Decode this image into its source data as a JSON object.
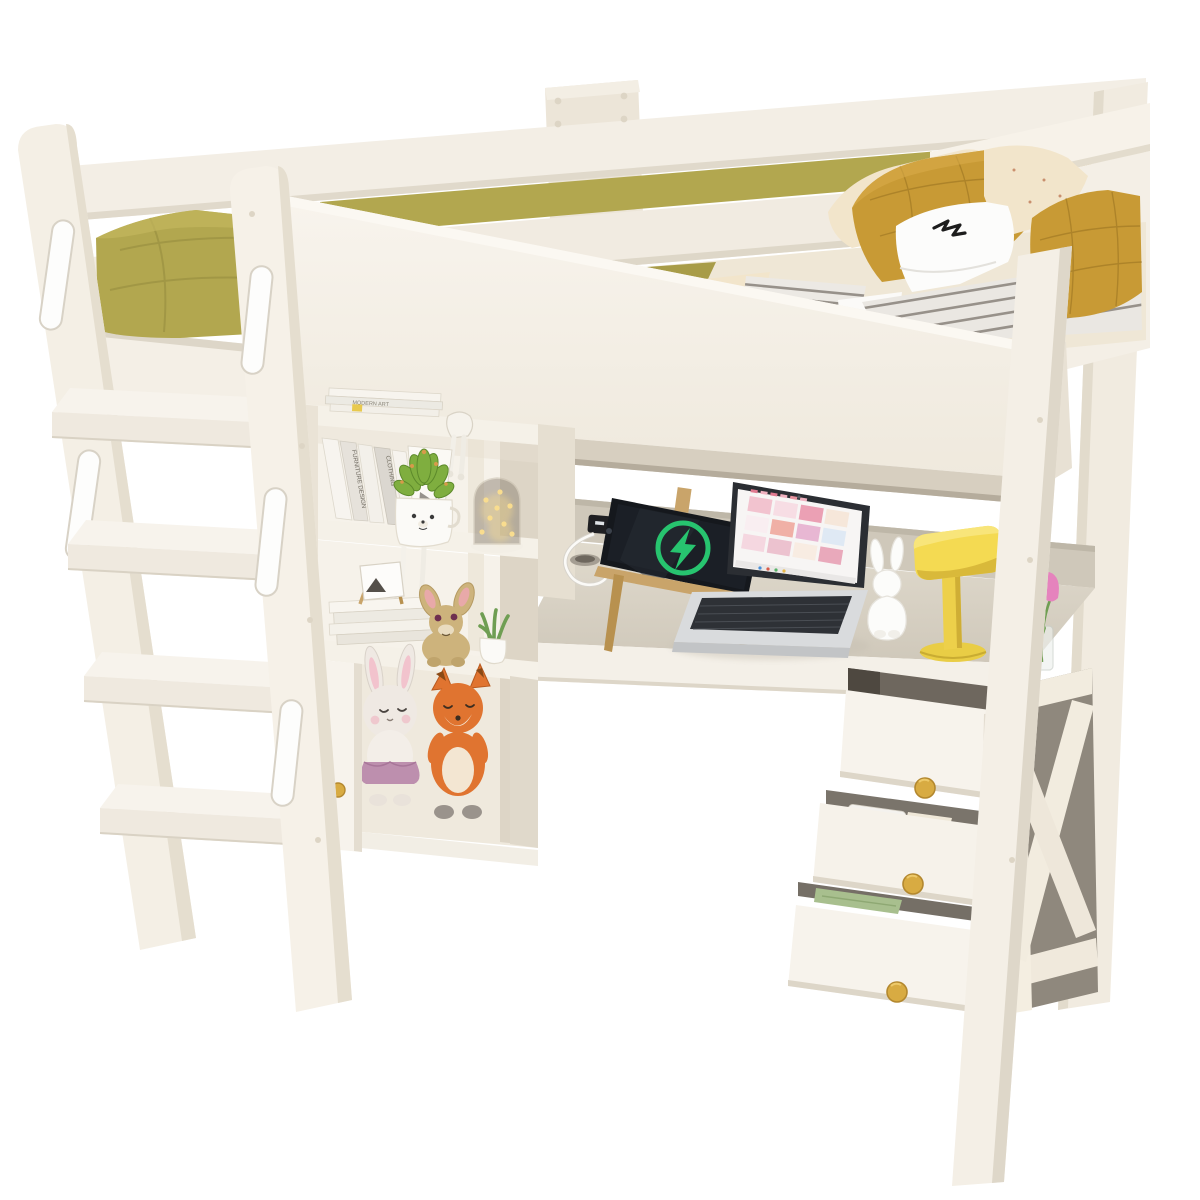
{
  "scene": {
    "title": "White loft bed with desk, bookshelf, open drawers and ladder",
    "type": "3D product render on seamless white background",
    "view": "three-quarter front view"
  },
  "palette": {
    "background": "#ffffff",
    "frame_white": "#f5f0e7",
    "frame_shade": "#e4ddd0",
    "frame_edge": "#d6cec0",
    "shadow_deep": "#b8b0a1",
    "desk_top": "#d8d1c4",
    "wall_strip": "#cfc8ba",
    "duvet_green": "#b2a74f",
    "duvet_green_dark": "#a0954a",
    "pillow_mustard": "#c89a35",
    "pillow_cream": "#f2e5cb",
    "pillow_white": "#fbfbf9",
    "stripe_gray": "#97918a",
    "laptop_silver": "#d9dbdd",
    "laptop_bezel": "#2b2e33",
    "screen_white": "#f7f5f4",
    "tablet_black": "#15181d",
    "charge_green": "#27c46f",
    "easel_wood": "#c9a46a",
    "lamp_yellow": "#f4da52",
    "bunny_white": "#fcfcfa",
    "fox_orange": "#e07430",
    "plush_bunny_gray": "#efe9e3",
    "tutu_mauve": "#bd8fae",
    "deer_tan": "#cdb37c",
    "succulent_green": "#7fae3f",
    "succulent_tip": "#d79a4a",
    "fairy_glow": "#f9dd8f",
    "knob_gold": "#d8ab42",
    "tulip_pink": "#e583bd",
    "stem_green": "#6f9e53",
    "marker_body": "#b9bdc2",
    "marker_colors": [
      "#2c2c30",
      "#cf4f2a",
      "#1f3f85",
      "#2f63b5",
      "#3e9fca",
      "#2e9e5b"
    ],
    "cable_white": "#fbfaf7",
    "usb_black": "#1f1f22"
  },
  "labels": {
    "book_spine_1": "FURNITURE DESIGN",
    "book_spine_2": "CLOTHING",
    "book_spine_3": "MODERN ARCHITECTURE",
    "magazine_stack": "MODERN ART"
  },
  "bed": {
    "guard_rails": 2,
    "handle_cutouts": 5,
    "bedding": [
      "olive green duvet",
      "mustard quilted pillows",
      "cream floral pillows",
      "white pillow with black stitch doodle",
      "gray striped mattress pad"
    ]
  },
  "ladder": {
    "steps": 4,
    "side": "left"
  },
  "bookshelf": {
    "rows": 3,
    "top_stack": "magazines with yellow page tab",
    "row1": [
      "leaning books",
      "succulent in bear-face pot with dangling legs",
      "fairy-light jar"
    ],
    "row2": [
      "stacked books",
      "easel photo frame with triangle logo",
      "tan deer plush figurine",
      "mini potted plant"
    ],
    "cabinet": [
      "open door with gold knob",
      "bunny plush in tutu",
      "fox plush"
    ]
  },
  "desk": {
    "items": [
      "tablet charging on wooden easel",
      "green charge ring with lightning bolt",
      "silver laptop with pink moodboard grid on screen",
      "white bunny figurine",
      "yellow desk lamp",
      "glass vase with pink tulip",
      "cable grommet",
      "black USB charging ports",
      "white charging cable"
    ]
  },
  "drawers": {
    "count": 3,
    "state": "stepped open",
    "knobs": "round gold",
    "contents": [
      "six art markers",
      "white pen and papers",
      "green folded paper"
    ]
  }
}
